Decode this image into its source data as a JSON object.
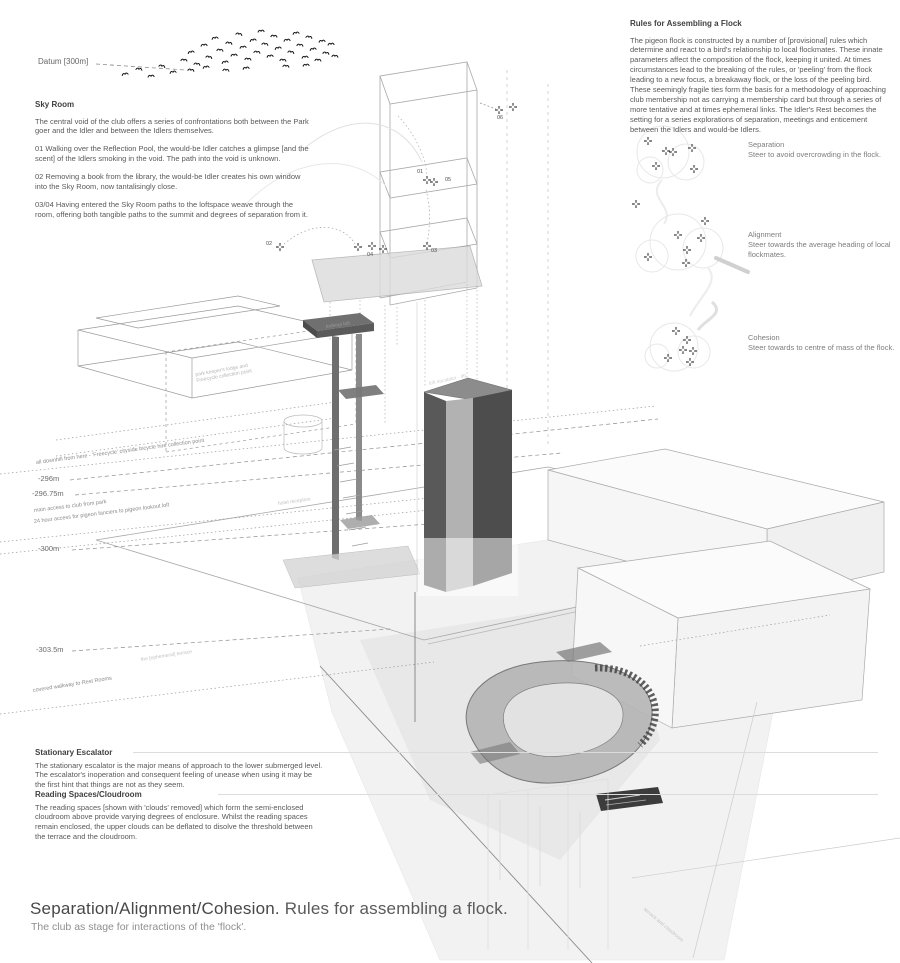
{
  "datum_label": "Datum [300m]",
  "sky_room": {
    "heading": "Sky Room",
    "paras": [
      "The central void of the club offers a series of confrontations both between the Park goer and the Idler and between the Idlers themselves.",
      "01 Walking over the Reflection Pool, the would-be Idler catches a glimpse [and the scent] of the Idlers smoking in the void. The path into the void is unknown.",
      "02 Removing a book from the library, the would-be Idler creates his own window into the Sky Room, now tantalisingly close.",
      "03/04 Having entered the Sky Room paths to the loftspace weave through the room, offering both tangible paths to the summit and degrees of separation from it."
    ]
  },
  "rules_block": {
    "heading": "Rules for Assembling a Flock",
    "paras": [
      "The pigeon flock is constructed by a number of [provisional] rules which determine and react to a bird's relationship to local flockmates. These innate parameters affect the composition of the flock, keeping it united. At times circumstances lead to the breaking of the rules, or 'peeling' from the flock leading to a new focus, a breakaway flock, or the loss of the peeling bird.",
      "These seemingly fragile ties form the basis for a methodology of approaching club membership not as carrying a membership card but through a series of more tentative and at times ephemeral links. The Idler's Rest becomes the setting for a series explorations of separation, meetings and enticement between the Idlers and would-be Idlers."
    ]
  },
  "flock_rules": [
    {
      "name": "Separation",
      "desc": "Steer to avoid overcrowding in the flock."
    },
    {
      "name": "Alignment",
      "desc": "Steer towards the average heading of local flockmates."
    },
    {
      "name": "Cohesion",
      "desc": "Steer towards to centre of mass of the flock."
    }
  ],
  "escalator_block": {
    "heading": "Stationary Escalator",
    "para": "The stationary escalator is the major means of approach to the lower submerged level. The escalator's inoperation and consequent feeling of unease when using it may be the first hint that things are not as they seem."
  },
  "cloudroom_block": {
    "heading": "Reading Spaces/Cloudroom",
    "para": "The reading spaces [shown with 'clouds' removed] which form the semi-enclosed cloudroom above provide varying degrees of enclosure. Whilst the reading spaces remain enclosed, the upper clouds can be deflated to disolve the threshold between the terrace and the cloudroom."
  },
  "elevations": [
    {
      "label": "-296m"
    },
    {
      "label": "-296.75m"
    },
    {
      "label": "-300m"
    },
    {
      "label": "-303.5m"
    }
  ],
  "annotations": {
    "downhill": "all downhill from here - 'Freecycle' cityside bicycle hire collection point",
    "main_access": "main access to club from park",
    "pigeon_access": "24 hour access for pigeon fanciers to pigeon lookout loft",
    "covered_walkway": "covered walkway to Rest Rooms",
    "ephemeral_terrace": "the [ephemeral] terrace",
    "park_keeper": "park keeper's lodge and Freecycle collection point",
    "lookout_loft": "lookout loft",
    "loft_escalator": "loft escalator - lift",
    "hotel_reception": "hotel reception",
    "terrace_cloudroom": "terrace and cloudroom"
  },
  "markers": {
    "m01": "01",
    "m02": "02",
    "m03": "03",
    "m04": "04",
    "m05": "05",
    "m06": "06"
  },
  "title_block": {
    "title_main": "Separation/Alignment/Cohesion.",
    "title_rest": " Rules for assembling a flock.",
    "subtitle": "The club as stage for interactions of the 'flock'."
  },
  "colors": {
    "ink": "#555555",
    "line": "#999999",
    "dark_mass": "#4f4f4f",
    "faint": "#cccccc"
  }
}
